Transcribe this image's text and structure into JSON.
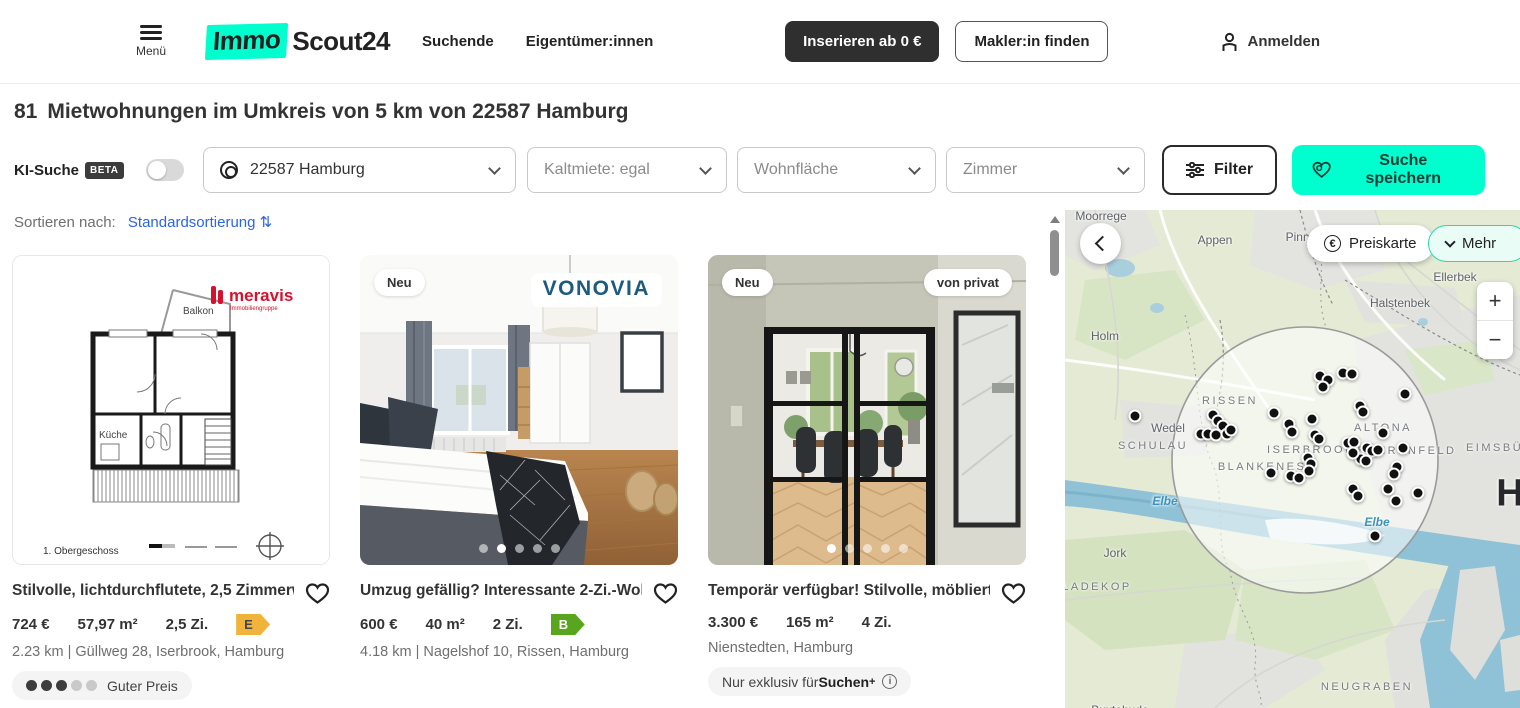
{
  "header": {
    "menu_label": "Menü",
    "logo_part1": "Immo",
    "logo_part2": "Scout24",
    "nav": [
      "Suchende",
      "Eigentümer:innen"
    ],
    "insert_button": "Inserieren ab 0 €",
    "makler_button": "Makler:in finden",
    "login_label": "Anmelden"
  },
  "page": {
    "results_count": "81",
    "results_title": "Mietwohnungen im Umkreis von 5 km von 22587 Hamburg"
  },
  "filters": {
    "ki_label": "KI-Suche",
    "beta": "BETA",
    "location_value": "22587 Hamburg",
    "kaltmiete_value": "Kaltmiete: egal",
    "wohnflaeche_placeholder": "Wohnfläche",
    "zimmer_placeholder": "Zimmer",
    "filter_button": "Filter",
    "save_search_button": "Suche speichern"
  },
  "sort": {
    "label": "Sortieren nach:",
    "value": "Standardsortierung ⇅"
  },
  "listings": [
    {
      "title": "Stilvolle, lichtdurchflutete, 2,5 Zimmerwo…",
      "price": "724 €",
      "area": "57,97 m²",
      "rooms": "2,5 Zi.",
      "energy_class": "E",
      "address": "2.23 km | Güllweg 28, Iserbrook, Hamburg",
      "price_rating_label": "Guter Preis",
      "price_rating_filled": 3,
      "price_rating_total": 5,
      "provider": "meravis",
      "provider_sub": "Immobiliengruppe",
      "floorplan": {
        "balkon": "Balkon",
        "kueche": "Küche",
        "floor_label": "1. Obergeschoss"
      }
    },
    {
      "badge_new": "Neu",
      "title": "Umzug gefällig? Interessante 2-Zi.-Wohn…",
      "price": "600 €",
      "area": "40 m²",
      "rooms": "2 Zi.",
      "energy_class": "B",
      "address": "4.18 km | Nagelshof 10, Rissen, Hamburg",
      "provider": "VONOVIA",
      "gallery_dots": 5,
      "active_dot": 1
    },
    {
      "badge_new": "Neu",
      "badge_private": "von privat",
      "title": "Temporär verfügbar! Stilvolle, möblierte …",
      "price": "3.300 €",
      "area": "165 m²",
      "rooms": "4 Zi.",
      "address": "Nienstedten, Hamburg",
      "exclusive_prefix": "Nur exklusiv für ",
      "exclusive_bold": "Suchen",
      "exclusive_sup": "+",
      "gallery_dots": 5,
      "active_dot": 0
    }
  ],
  "map": {
    "preiskarte_button": "Preiskarte",
    "mehr_button": "Mehr",
    "zoom_in": "+",
    "zoom_out": "−",
    "labels": [
      {
        "text": "Moorrege",
        "x": 36,
        "y": 6,
        "cls": "place"
      },
      {
        "text": "Appen",
        "x": 150,
        "y": 30,
        "cls": "place"
      },
      {
        "text": "Pinneberg",
        "x": 248,
        "y": 27,
        "cls": "place"
      },
      {
        "text": "Ellerbek",
        "x": 390,
        "y": 67,
        "cls": "place"
      },
      {
        "text": "Halstenbek",
        "x": 335,
        "y": 93,
        "cls": "place"
      },
      {
        "text": "Holm",
        "x": 40,
        "y": 126,
        "cls": "place"
      },
      {
        "text": "Wedel",
        "x": 103,
        "y": 218,
        "cls": "place"
      },
      {
        "text": "SCHULAU",
        "x": 88,
        "y": 236,
        "cls": "area"
      },
      {
        "text": "RISSEN",
        "x": 165,
        "y": 191,
        "cls": "area"
      },
      {
        "text": "BLANKENESE",
        "x": 202,
        "y": 257,
        "cls": "area"
      },
      {
        "text": "ISERBROOK",
        "x": 246,
        "y": 240,
        "cls": "area"
      },
      {
        "text": "ALTONA",
        "x": 318,
        "y": 218,
        "cls": "area"
      },
      {
        "text": "BAHRENFELD",
        "x": 342,
        "y": 241,
        "cls": "area"
      },
      {
        "text": "EIMSBÜTTEL",
        "x": 448,
        "y": 238,
        "cls": "area"
      },
      {
        "text": "Elbe",
        "x": 100,
        "y": 291,
        "cls": "water"
      },
      {
        "text": "Elbe",
        "x": 312,
        "y": 312,
        "cls": "water"
      },
      {
        "text": "Jork",
        "x": 50,
        "y": 343,
        "cls": "place"
      },
      {
        "text": "LADEKOP",
        "x": 32,
        "y": 377,
        "cls": "area"
      },
      {
        "text": "NEUGRABEN",
        "x": 302,
        "y": 477,
        "cls": "area"
      },
      {
        "text": "Buxtehude",
        "x": 55,
        "y": 500,
        "cls": "place"
      },
      {
        "text": "H",
        "x": 446,
        "y": 284,
        "cls": "city"
      }
    ],
    "markers": [
      [
        70,
        206
      ],
      [
        148,
        205
      ],
      [
        153,
        211
      ],
      [
        158,
        216
      ],
      [
        136,
        224
      ],
      [
        143,
        224
      ],
      [
        151,
        225
      ],
      [
        162,
        224
      ],
      [
        166,
        220
      ],
      [
        209,
        203
      ],
      [
        224,
        214
      ],
      [
        227,
        222
      ],
      [
        247,
        209
      ],
      [
        255,
        166
      ],
      [
        263,
        170
      ],
      [
        258,
        177
      ],
      [
        278,
        163
      ],
      [
        287,
        164
      ],
      [
        340,
        184
      ],
      [
        295,
        196
      ],
      [
        298,
        202
      ],
      [
        250,
        225
      ],
      [
        254,
        229
      ],
      [
        283,
        233
      ],
      [
        289,
        232
      ],
      [
        302,
        238
      ],
      [
        307,
        241
      ],
      [
        313,
        240
      ],
      [
        318,
        223
      ],
      [
        338,
        238
      ],
      [
        296,
        249
      ],
      [
        288,
        243
      ],
      [
        301,
        251
      ],
      [
        243,
        248
      ],
      [
        246,
        254
      ],
      [
        244,
        261
      ],
      [
        206,
        263
      ],
      [
        226,
        266
      ],
      [
        234,
        268
      ],
      [
        332,
        257
      ],
      [
        329,
        264
      ],
      [
        288,
        279
      ],
      [
        293,
        286
      ],
      [
        323,
        279
      ],
      [
        331,
        291
      ],
      [
        353,
        283
      ],
      [
        310,
        326
      ]
    ]
  },
  "colors": {
    "brand_mint": "#00ffce",
    "accent_dark": "#2f2f2f",
    "link_blue": "#2a64e8",
    "energy_e": "#f0b43c",
    "energy_b": "#5aa51e"
  }
}
